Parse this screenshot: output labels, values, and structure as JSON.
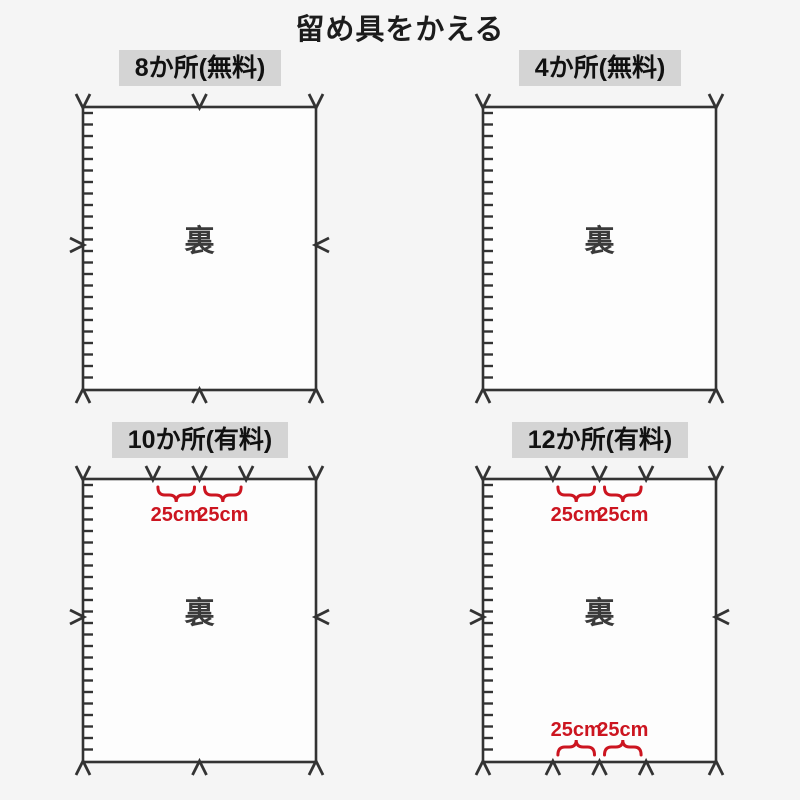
{
  "title": "留め具をかえる",
  "measure_label": "25cm",
  "colors": {
    "ink": "#333333",
    "accent_red": "#cc1520",
    "header_bg": "#d4d4d4",
    "page_bg": "#f5f5f5",
    "panel_fill": "#fdfdfd",
    "back_text": "#3a3a3a"
  },
  "panels": [
    {
      "name": "8-places-free",
      "header": "8か所(無料)",
      "back_label": "裏",
      "top_marks": [
        0,
        0.5,
        1
      ],
      "bottom_marks": [
        0,
        0.5,
        1
      ],
      "side_marks": true,
      "top_measures": false,
      "bottom_measures": false
    },
    {
      "name": "4-places-free",
      "header": "4か所(無料)",
      "back_label": "裏",
      "top_marks": [
        0,
        1
      ],
      "bottom_marks": [
        0,
        1
      ],
      "side_marks": false,
      "top_measures": false,
      "bottom_measures": false
    },
    {
      "name": "10-places-paid",
      "header": "10か所(有料)",
      "back_label": "裏",
      "top_marks": [
        0,
        0.3,
        0.5,
        0.7,
        1
      ],
      "bottom_marks": [
        0,
        0.5,
        1
      ],
      "side_marks": true,
      "top_measures": true,
      "bottom_measures": false
    },
    {
      "name": "12-places-paid",
      "header": "12か所(有料)",
      "back_label": "裏",
      "top_marks": [
        0,
        0.3,
        0.5,
        0.7,
        1
      ],
      "bottom_marks": [
        0,
        0.3,
        0.5,
        0.7,
        1
      ],
      "side_marks": true,
      "top_measures": true,
      "bottom_measures": true
    }
  ]
}
